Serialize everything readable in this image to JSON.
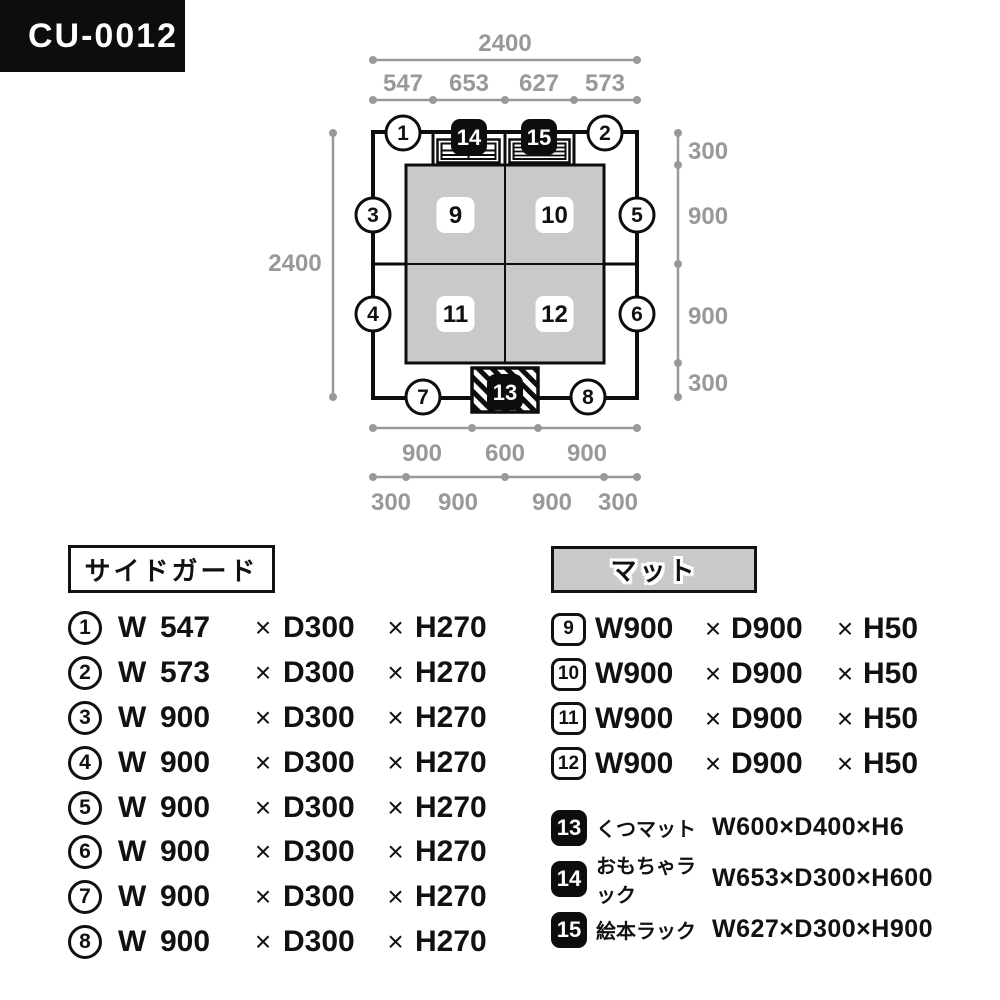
{
  "model_badge": {
    "label": "CU-0012"
  },
  "multiply": "×",
  "colors": {
    "black": "#0d0d0d",
    "dim_gray": "#999999",
    "mat_gray": "#c9c9c9"
  },
  "plan": {
    "dims": {
      "top_total": "2400",
      "top_segments": [
        "547",
        "653",
        "627",
        "573"
      ],
      "left_total": "2400",
      "right_segments": [
        "300",
        "900",
        "900",
        "300"
      ],
      "bottom_row1": [
        "900",
        "600",
        "900"
      ],
      "bottom_row2": [
        "300",
        "900",
        "900",
        "300"
      ]
    },
    "guards": [
      "1",
      "2",
      "3",
      "4",
      "5",
      "6",
      "7",
      "8"
    ],
    "mats": [
      "9",
      "10",
      "11",
      "12"
    ],
    "accessories": [
      "13",
      "14",
      "15"
    ]
  },
  "legend_left": {
    "title": "サイドガード",
    "items": [
      {
        "num": "1",
        "w_label": "W",
        "w_value": "547",
        "d": "D300",
        "h": "H270"
      },
      {
        "num": "2",
        "w_label": "W",
        "w_value": "573",
        "d": "D300",
        "h": "H270"
      },
      {
        "num": "3",
        "w_label": "W",
        "w_value": "900",
        "d": "D300",
        "h": "H270"
      },
      {
        "num": "4",
        "w_label": "W",
        "w_value": "900",
        "d": "D300",
        "h": "H270"
      },
      {
        "num": "5",
        "w_label": "W",
        "w_value": "900",
        "d": "D300",
        "h": "H270"
      },
      {
        "num": "6",
        "w_label": "W",
        "w_value": "900",
        "d": "D300",
        "h": "H270"
      },
      {
        "num": "7",
        "w_label": "W",
        "w_value": "900",
        "d": "D300",
        "h": "H270"
      },
      {
        "num": "8",
        "w_label": "W",
        "w_value": "900",
        "d": "D300",
        "h": "H270"
      }
    ]
  },
  "legend_right": {
    "title": "マット",
    "items": [
      {
        "num": "9",
        "w": "W900",
        "d": "D900",
        "h": "H50"
      },
      {
        "num": "10",
        "w": "W900",
        "d": "D900",
        "h": "H50"
      },
      {
        "num": "11",
        "w": "W900",
        "d": "D900",
        "h": "H50"
      },
      {
        "num": "12",
        "w": "W900",
        "d": "D900",
        "h": "H50"
      }
    ],
    "accessories": [
      {
        "num": "13",
        "name": "くつマット",
        "size": "W600×D400×H6"
      },
      {
        "num": "14",
        "name": "おもちゃラック",
        "size": "W653×D300×H600"
      },
      {
        "num": "15",
        "name": "絵本ラック",
        "size": "W627×D300×H900"
      }
    ]
  }
}
